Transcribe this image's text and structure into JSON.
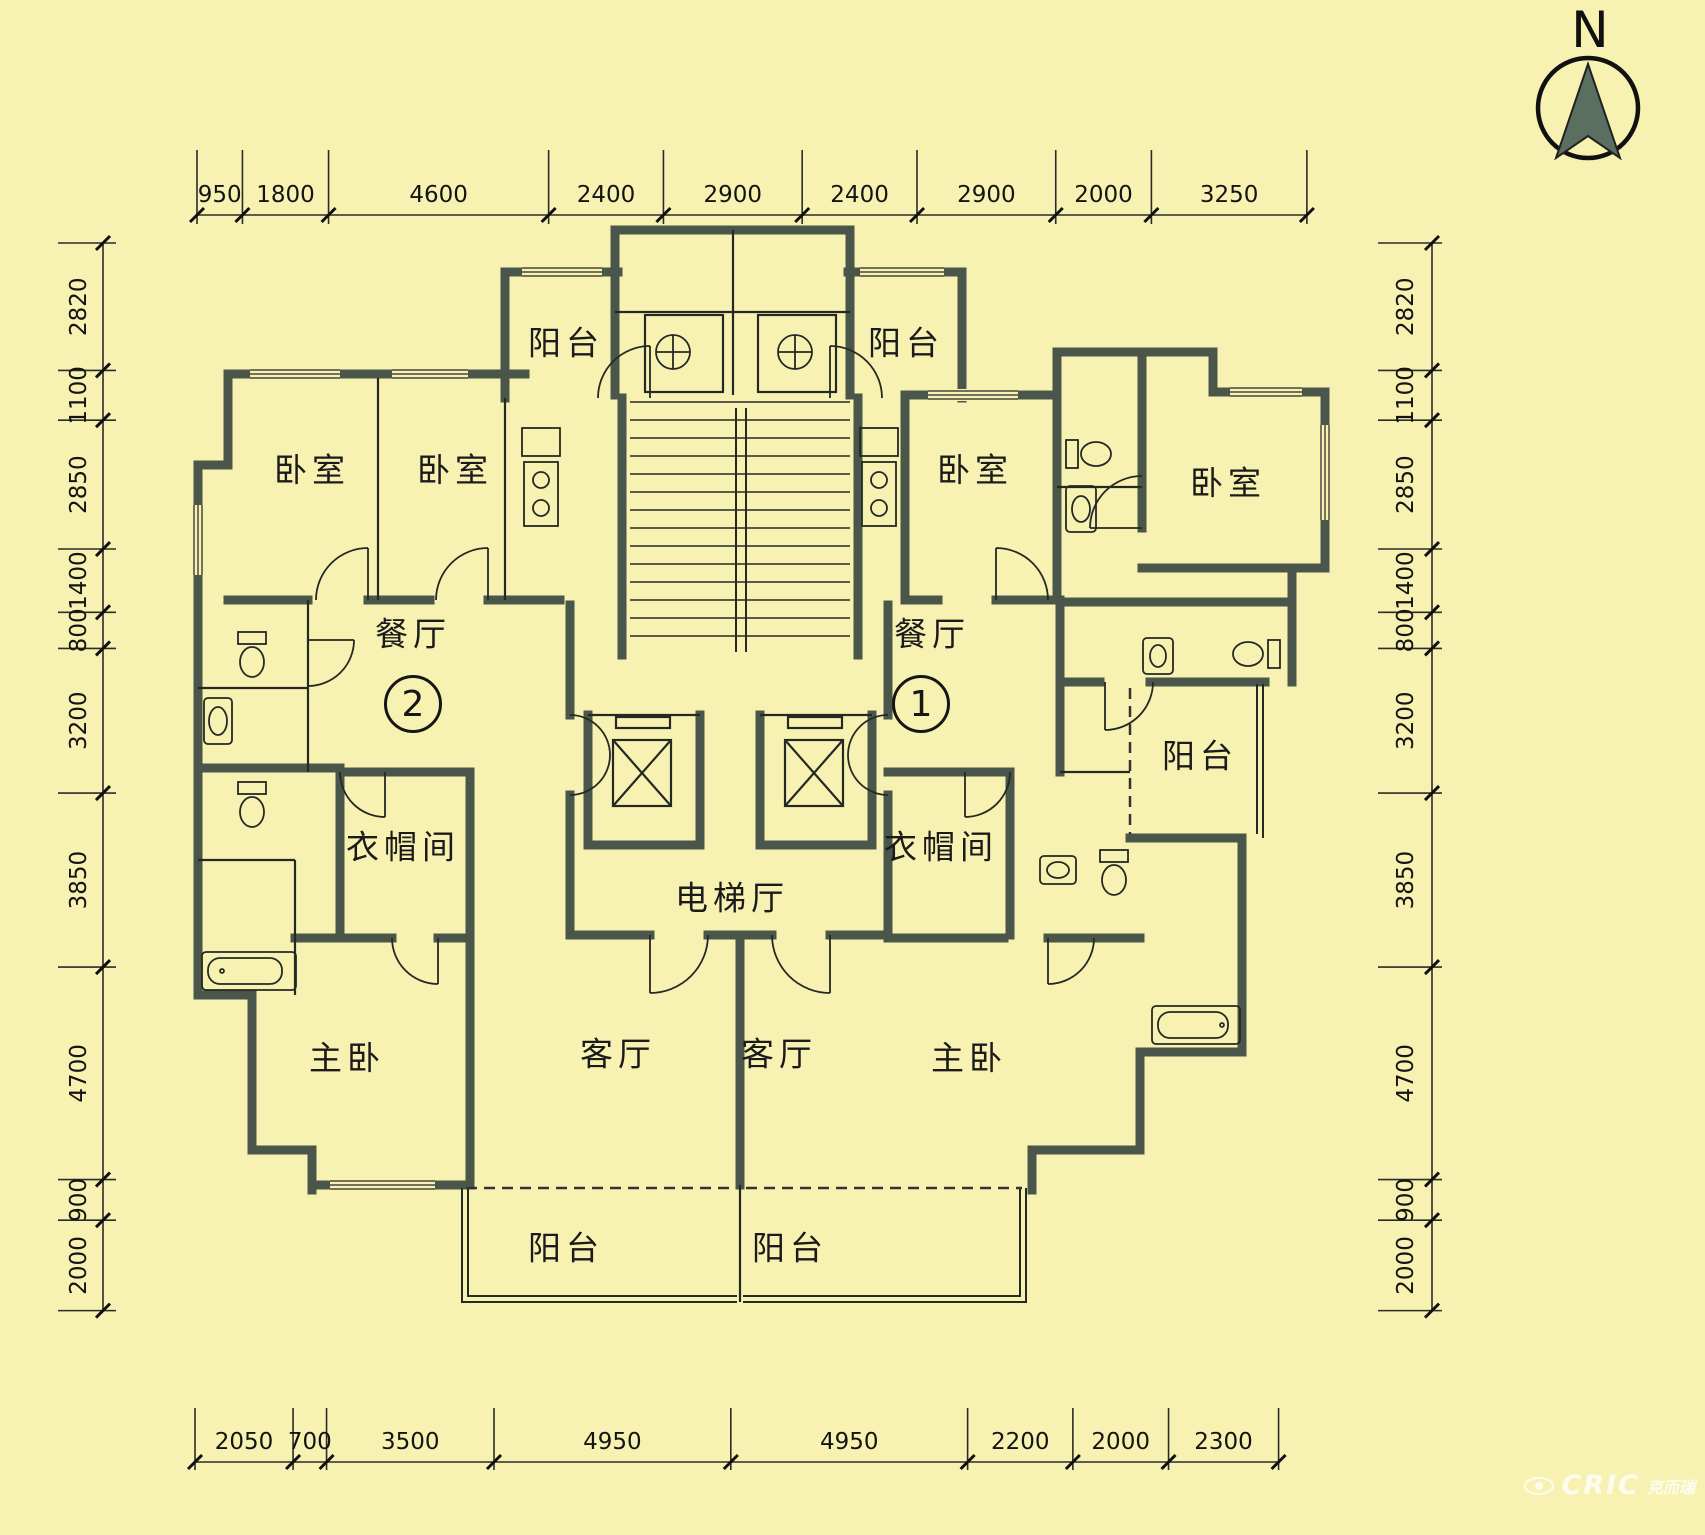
{
  "compass": {
    "label": "N"
  },
  "watermark": {
    "brand": "CRIC",
    "company": "克而瑞"
  },
  "units": {
    "left_badge": "2",
    "right_badge": "1"
  },
  "rooms": {
    "balcony": "阳台",
    "bedroom": "卧室",
    "dining": "餐厅",
    "cloakroom": "衣帽间",
    "elevator_hall": "电梯厅",
    "living": "客厅",
    "master_bedroom": "主卧"
  },
  "dimensions": {
    "top": [
      "950",
      "1800",
      "4600",
      "2400",
      "2900",
      "2400",
      "2900",
      "2000",
      "3250"
    ],
    "bottom": [
      "2050",
      "700",
      "3500",
      "4950",
      "4950",
      "2200",
      "2000",
      "2300"
    ],
    "left": [
      "2820",
      "1100",
      "2850",
      "1400",
      "800",
      "3200",
      "3850",
      "4700",
      "900",
      "2000"
    ],
    "right": [
      "2820",
      "1100",
      "2850",
      "1400",
      "800",
      "3200",
      "3850",
      "4700",
      "900",
      "2000"
    ]
  },
  "colors": {
    "background": "#f8f2b2",
    "wall": "#4a564a",
    "line": "#222222",
    "compass_fill": "#5a6f60",
    "text": "#161616",
    "watermark": "#ffffff"
  }
}
